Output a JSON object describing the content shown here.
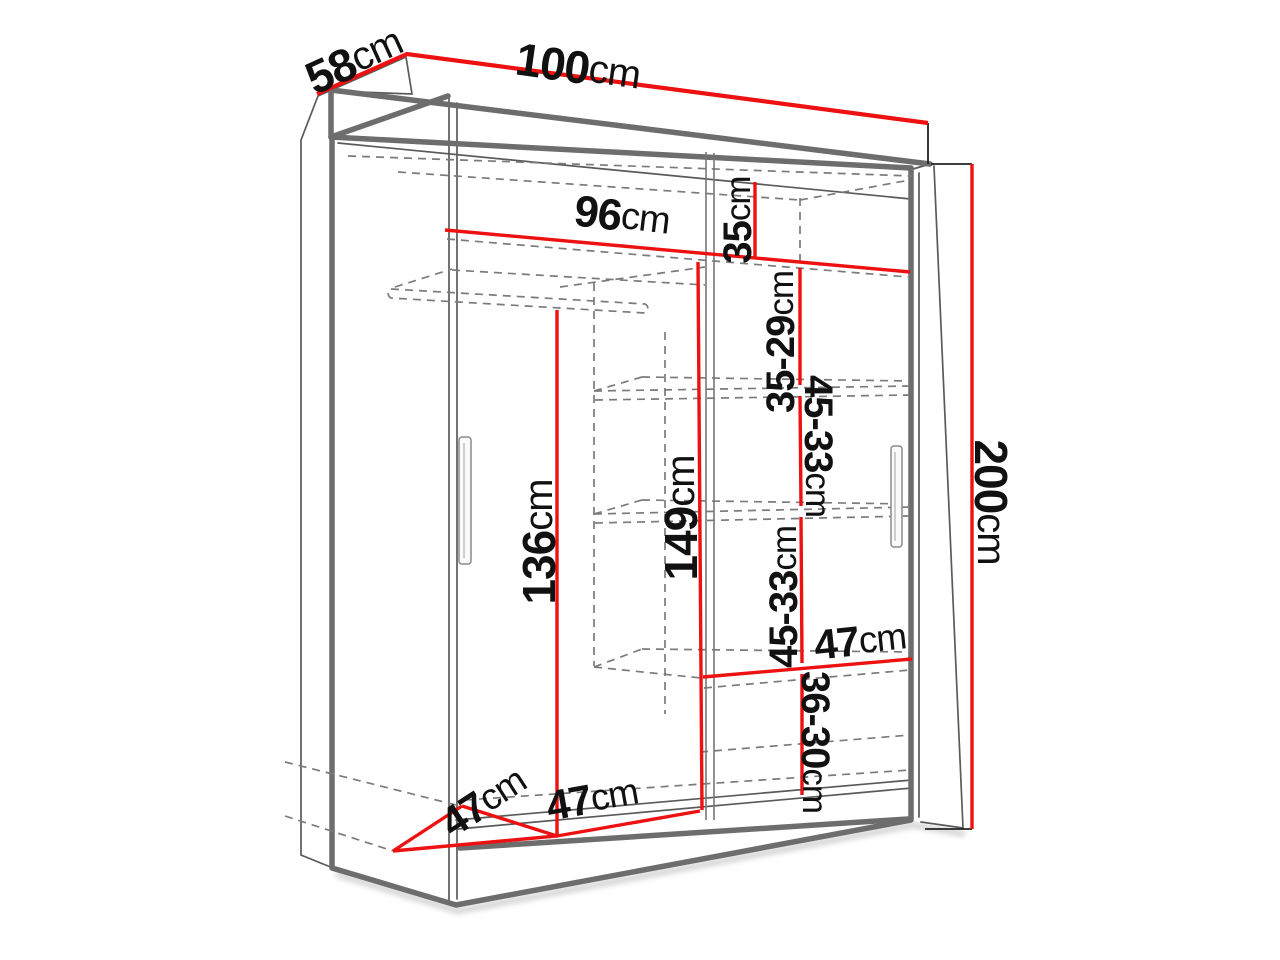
{
  "diagram": {
    "type": "wardrobe-dimension-diagram",
    "unit": "cm",
    "colors": {
      "dimension_line": "#ed1111",
      "outline": "#6d6d6d",
      "hidden_edge": "#7b7b7b",
      "label_text": "#111111",
      "background": "#ffffff"
    },
    "labels": {
      "depth_top": {
        "value": "58",
        "unit": "cm"
      },
      "width_top": {
        "value": "100",
        "unit": "cm"
      },
      "interior_width": {
        "value": "96",
        "unit": "cm"
      },
      "top_gap": {
        "value": "35",
        "unit": "cm"
      },
      "gap_35_29": {
        "value": "35-29",
        "unit": "cm"
      },
      "gap_45_33_a": {
        "value": "45-33",
        "unit": "cm"
      },
      "gap_45_33_b": {
        "value": "45-33",
        "unit": "cm"
      },
      "gap_36_30": {
        "value": "36-30",
        "unit": "cm"
      },
      "hanging_height": {
        "value": "136",
        "unit": "cm"
      },
      "inner_height": {
        "value": "149",
        "unit": "cm"
      },
      "total_height": {
        "value": "200",
        "unit": "cm"
      },
      "shelf_width": {
        "value": "47",
        "unit": "cm"
      },
      "floor_depth": {
        "value": "47",
        "unit": "cm"
      },
      "floor_width": {
        "value": "47",
        "unit": "cm"
      }
    }
  }
}
